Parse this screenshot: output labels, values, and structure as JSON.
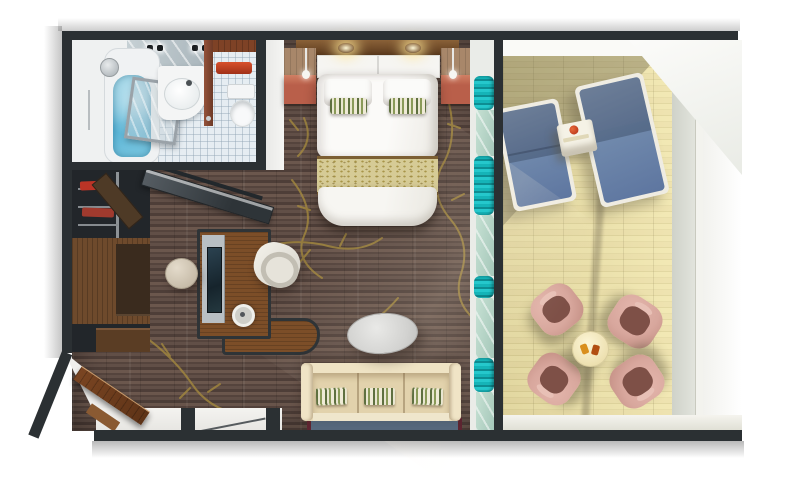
{
  "title": "3D top-down floor plan of a suite with bathroom, bedroom, living area and furnished balcony",
  "rooms": {
    "bathroom": {
      "name": "bathroom",
      "items": [
        "bathtub-with-water",
        "shower-head",
        "glass-shower-door",
        "vanity-mirror-lights",
        "washbasin",
        "wooden-door",
        "red-towel-rail",
        "toilet",
        "tiled-floor"
      ]
    },
    "bedroom": {
      "name": "bedroom",
      "items": [
        "double-bed",
        "headboard",
        "light-canopy",
        "pillows",
        "striped-accent-pillows",
        "gold-runner",
        "nightstand-left",
        "nightstand-right",
        "pendant-lamps",
        "teal-curtains"
      ]
    },
    "living_room": {
      "name": "living-room",
      "items": [
        "wardrobe-with-shelves",
        "sliding-mirror-door",
        "desk-with-tv-panel",
        "desk-lamp",
        "desk-chair",
        "stool",
        "oval-coffee-table",
        "sofa",
        "green-striped-cushions",
        "rug",
        "entry-door",
        "gold-branch-carpet"
      ]
    },
    "balcony": {
      "name": "balcony",
      "items": [
        "wood-decking",
        "sun-lounger-left",
        "sun-lounger-right",
        "side-table-with-drink",
        "round-table-with-drinks",
        "armchair-top-left",
        "armchair-top-right",
        "armchair-bottom-left",
        "armchair-bottom-right",
        "glass-railing",
        "railing-post"
      ]
    }
  },
  "palette": {
    "wall": "#2b3033",
    "carpet": "#5d4b43",
    "gold": "#a58a3e",
    "deck": "#ecdfa3",
    "deck-shade": "rgba(88,82,60,0.34)",
    "teal": "#15b4b8",
    "water": "#5cb6d8",
    "tile": "#e6edf2",
    "wood": "#6e4a2c",
    "wood-desk": "#7c4e28",
    "wood-red": "#b95f4a",
    "wood-red-top": "#d07f63",
    "wood-door": "#8a4a30",
    "red-accent": "#c5402a",
    "bed-white": "#f6f5f2",
    "runner": "#d6cb96",
    "runner-border": "#7c5f33",
    "sofa": "#e9dcba",
    "sofa-seat": "#e2d2ac",
    "rug": "#56687c",
    "rug-border": "#5e2531",
    "lounger": "#7089ac",
    "lounger-frame": "#efece2",
    "pink": "#d8a79d",
    "pink-dark": "#7e5047",
    "cream-table": "#f7efcf",
    "silver": "#b9bfc3",
    "screen": "#20303a",
    "ledge": "#eceade"
  }
}
